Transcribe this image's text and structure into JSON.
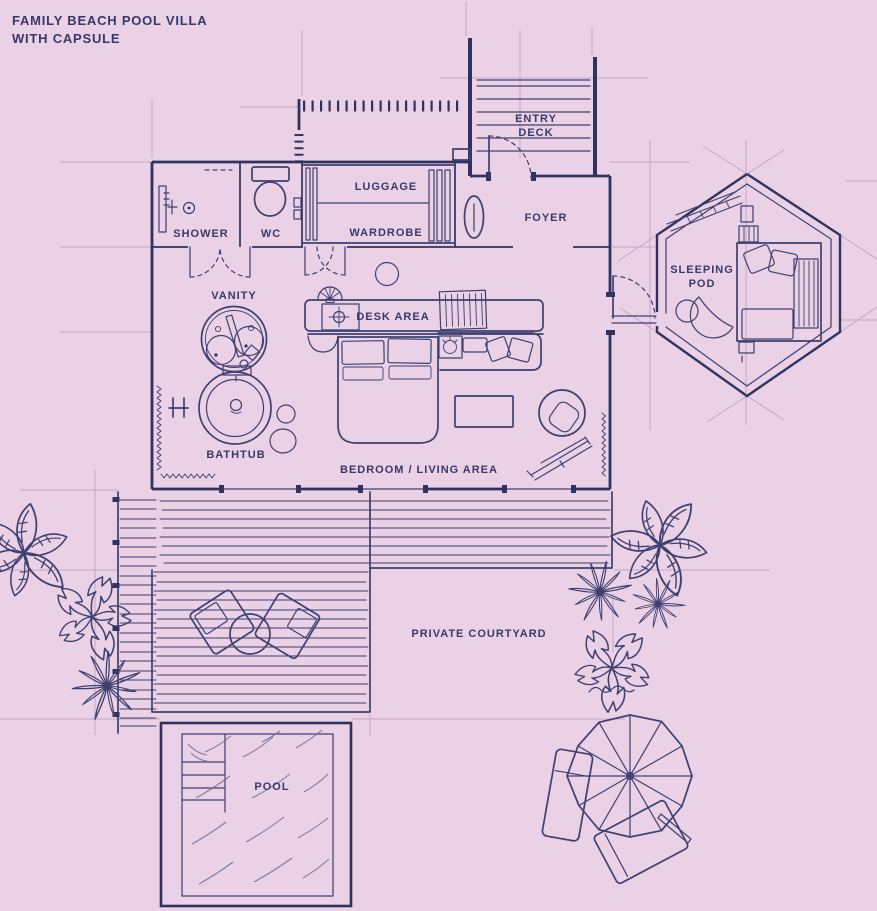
{
  "title": {
    "line1": "FAMILY BEACH POOL VILLA",
    "line2": "WITH CAPSULE"
  },
  "labels": {
    "entry_deck_line1": "ENTRY",
    "entry_deck_line2": "DECK",
    "foyer": "FOYER",
    "luggage": "LUGGAGE",
    "wardrobe": "WARDROBE",
    "shower": "SHOWER",
    "wc": "WC",
    "vanity": "VANITY",
    "desk_area": "DESK AREA",
    "bathtub": "BATHTUB",
    "bedroom_living_area": "BEDROOM / LIVING AREA",
    "sleeping_pod_line1": "SLEEPING",
    "sleeping_pod_line2": "POD",
    "private_courtyard": "PRIVATE COURTYARD",
    "pool": "POOL"
  },
  "colors": {
    "background": "#ebd1e5",
    "ink": "#3d4070",
    "ink_strong": "#30335f",
    "text": "#363a6b",
    "guide": "#c2a2c4",
    "water": "#6a6d97"
  }
}
